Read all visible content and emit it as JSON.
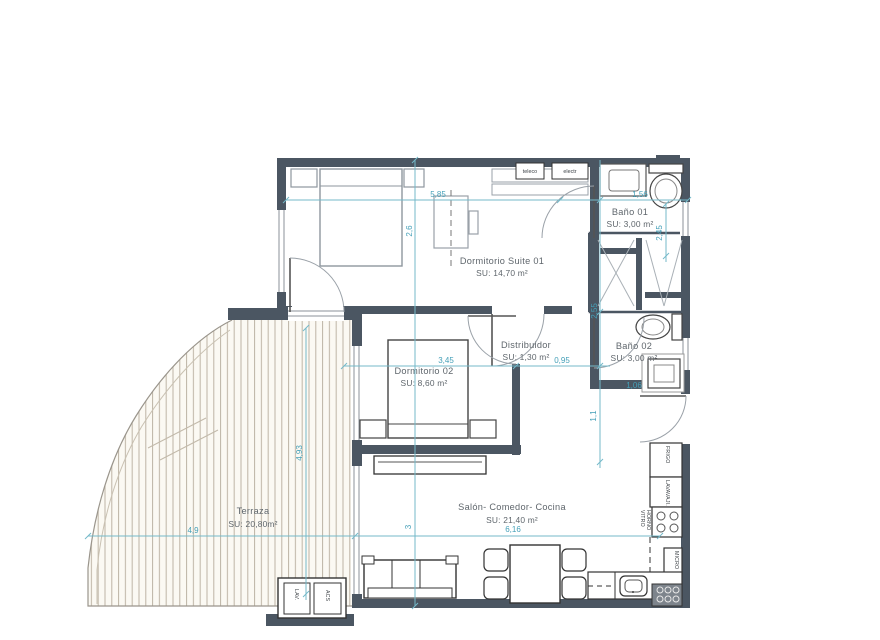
{
  "colors": {
    "wall": "#4b5662",
    "dim_line": "#74b9c9",
    "dim_text": "#45a0b8",
    "label_text": "#5f666c",
    "deck_line": "#bdb4a5",
    "deck_bg": "#fbf9f3"
  },
  "rooms": {
    "suite": {
      "name": "Dormitorio Suite 01",
      "area": "SU: 14,70 m²"
    },
    "bano1": {
      "name": "Baño 01",
      "area": "SU: 3,00 m²"
    },
    "distribuidor": {
      "name": "Distribuidor",
      "area": "SU: 1,30 m²"
    },
    "bano2": {
      "name": "Baño 02",
      "area": "SU: 3,00 m²"
    },
    "dorm2": {
      "name": "Dormitorio 02",
      "area": "SU: 8,60 m²"
    },
    "salon": {
      "name": "Salón- Comedor- Cocina",
      "area": "SU: 21,40 m²"
    },
    "terraza": {
      "name": "Terraza",
      "area": "SU: 20,80m²"
    }
  },
  "dims": {
    "d585": "5,85",
    "d26": "2,6",
    "d156": "1,56",
    "d245": "2,45",
    "d255": "2,55",
    "d345": "3,45",
    "d095": "0,95",
    "d106": "1,06",
    "d11": "1,1",
    "d49": "4,9",
    "d493": "4,93",
    "d616": "6,16",
    "d3": "3"
  },
  "labels": {
    "teleco": "teleco",
    "electr": "electr",
    "frigo": "FRIGO",
    "lavavajillas": "LAVAVAJI.",
    "vitro": "VITRO",
    "horno": "HORNO",
    "micro": "MICRO",
    "lav": "LAV.",
    "acs": "ACS"
  }
}
